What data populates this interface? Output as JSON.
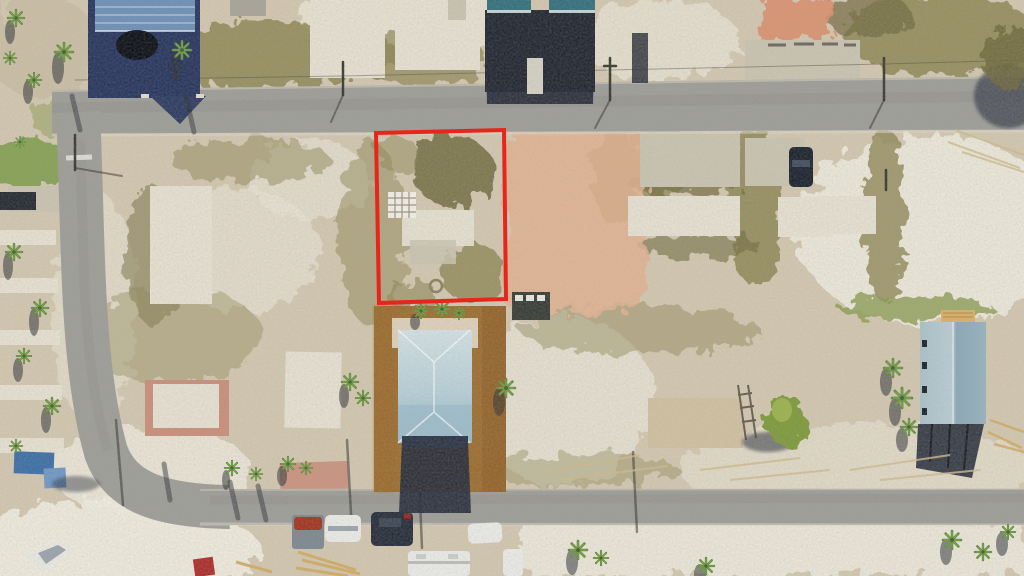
{
  "scene": {
    "type": "aerial-photo",
    "description": "Aerial drone photo of a coastal residential street grid with mostly vacant sandy lots, bare concrete slab foundations, palm trees, two paved cross streets, a few rebuilt houses with blue metal roofs, parked vehicles, and a vacant parcel outlined in red for a real-estate listing",
    "annotation_label": "red parcel boundary outline",
    "text_content": "none - photograph contains no readable UI text"
  },
  "colors": {
    "sand_base": "#d2c7b1",
    "sand_light": "#e7e2d4",
    "sand_white": "#efece2",
    "sand_dark": "#c3b79d",
    "veg_olive": "#8d8656",
    "veg_dark": "#6f6a40",
    "grass_green": "#8a9b52",
    "lawn_green": "#83a052",
    "slab_white": "#e5e0d2",
    "slab_gray": "#c9c3b2",
    "pink_sand": "#e2b193",
    "pink_slab": "#c98e7c",
    "road_gray": "#9d9d99",
    "road_dark": "#8d8d88",
    "dirt_brown": "#9a6a2e",
    "navy_house": "#28365f",
    "navy_roof": "#6d8fb8",
    "dark_building": "#222834",
    "teal_roof": "#34707f",
    "roof_light_blue": "#c6d8de",
    "roof_mid_blue": "#9cbccb",
    "roof_dark_blue": "#6f9cb0",
    "right_roof_blue": "#a3bcc6",
    "shadow_navy": "#272e3c",
    "red_boundary": "#e8251a",
    "vehicle_white": "#e9eae8",
    "vehicle_red": "#a23524",
    "bin_blue": "#3d6fa8",
    "lumber_tan": "#d0ab66",
    "palm_dark": "#5f8a3e",
    "palm_light": "#79a348",
    "pole_dark": "#3a3a33"
  },
  "objects": [
    {
      "name": "parcel-boundary-outline",
      "label": "red outlined vacant parcel"
    },
    {
      "name": "top-street",
      "label": "upper paved street"
    },
    {
      "name": "left-street",
      "label": "left curving street"
    },
    {
      "name": "bottom-street",
      "label": "lower paved street"
    },
    {
      "name": "house-top-left",
      "label": "navy blue roofed house"
    },
    {
      "name": "building-top-center",
      "label": "teal roofed building with shadow"
    },
    {
      "name": "house-center-blue-roof",
      "label": "light blue metal roof house on dirt lot"
    },
    {
      "name": "house-right-blue-roof",
      "label": "blue roofed elevated house under construction"
    },
    {
      "name": "slab-foundations",
      "label": "bare concrete slab foundations"
    },
    {
      "name": "palm-trees",
      "label": "palm trees"
    },
    {
      "name": "parked-vehicles",
      "label": "parked cars, vans, RV and boat"
    }
  ]
}
